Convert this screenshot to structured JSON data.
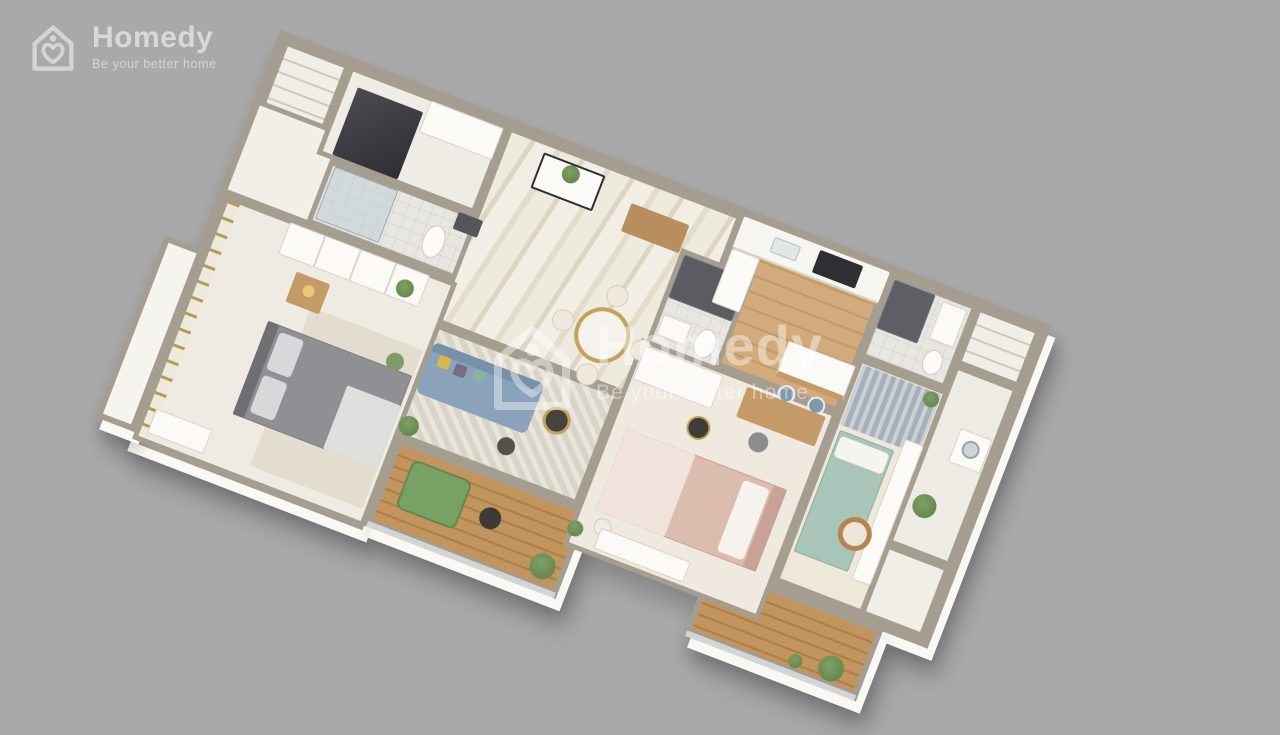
{
  "brand": {
    "name": "Homedy",
    "tagline": "Be your better home"
  },
  "watermark": {
    "name": "Homedy",
    "tagline": "Be your better home."
  },
  "colors": {
    "background": "#a9a9ab",
    "wall": "#a69d91",
    "floor": "#f1eee7",
    "marble": "#ece7dc",
    "wood_floor": "#cda676",
    "wood_deck": "#bd8f58",
    "sofa_blue": "#8aa3ba",
    "bed_gray": "#909094",
    "bed_pink": "#dcbcae",
    "bed_teal": "#a9c4b8",
    "plant_green": "#6d8f58",
    "accent_gold": "#c2a35c"
  },
  "floorplan": {
    "type": "3d-apartment-render",
    "rotation_deg": 21,
    "rooms": [
      "entry-hall-with-dark-wardrobe",
      "top-closet",
      "bathroom-1-toilet-shower",
      "master-bedroom-gray-bed",
      "left-balcony-ledge",
      "foyer-marble-with-console-and-bench",
      "dining-round-table-four-chairs",
      "living-room-blue-sofa",
      "bathroom-2-dark-shower",
      "bedroom-2-pink-bed-desk",
      "kitchen-wood-floor-island-two-stools",
      "bathroom-3-dark-shower",
      "storage-closet",
      "utility-room-washer-plant",
      "bedroom-3-teal-bed-mirror-sofa",
      "right-small-balcony",
      "wood-deck-balcony-left-lounge-chair",
      "wood-deck-balcony-right-plants"
    ]
  }
}
